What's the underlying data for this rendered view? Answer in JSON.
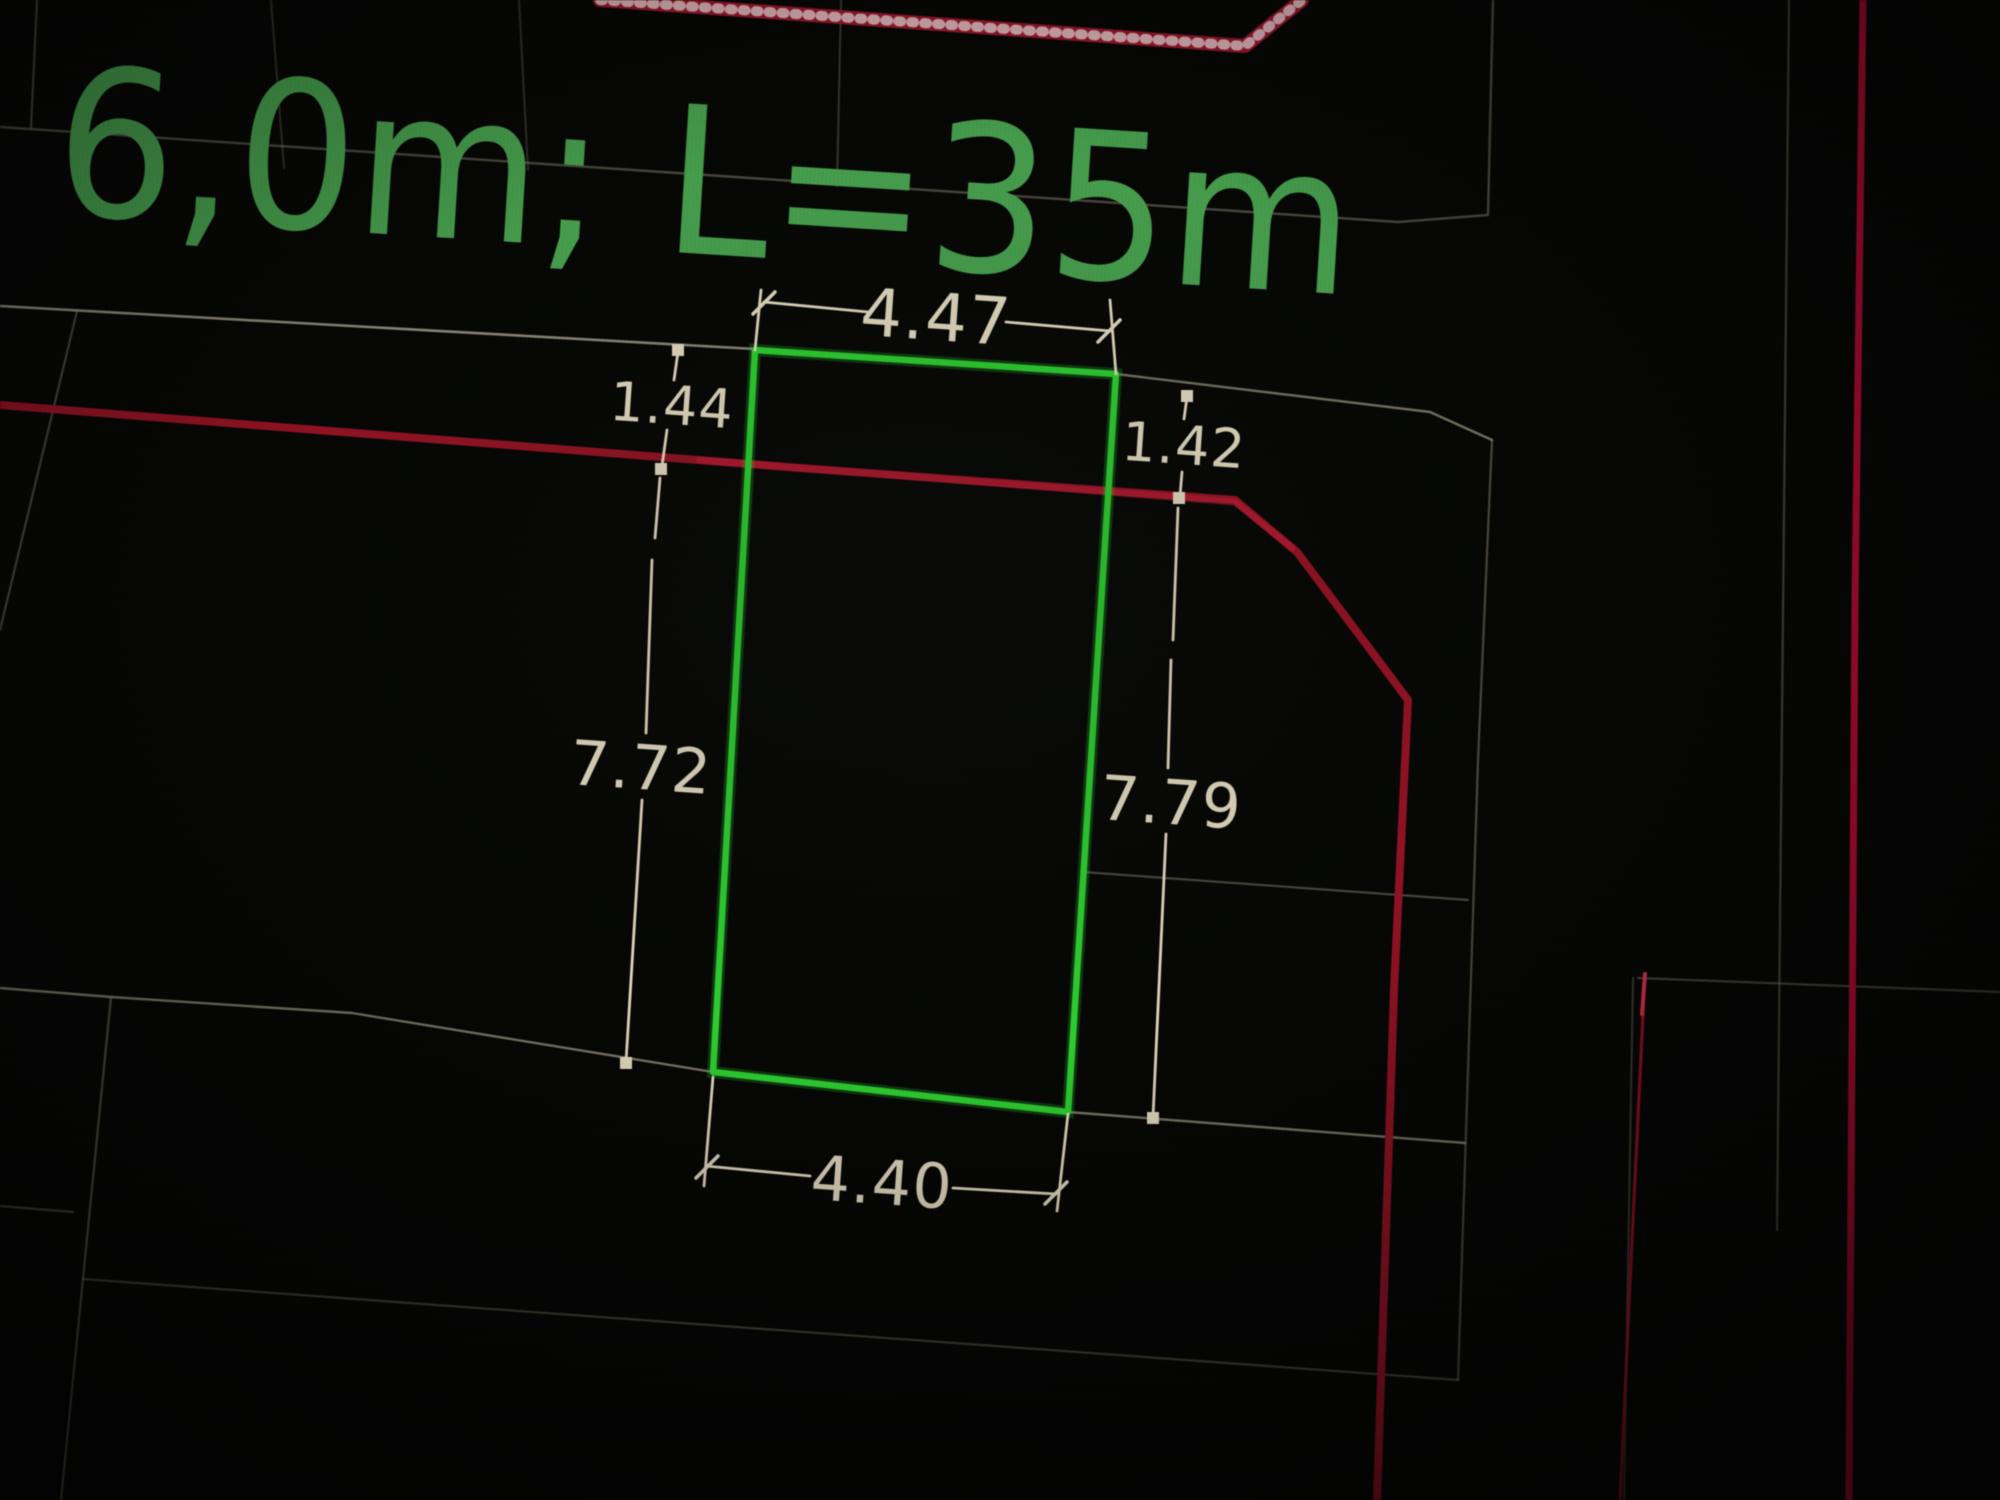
{
  "scene": {
    "description": "Photo of a CAD site plan on screen: highlighted parcel rectangle with measured dimensions",
    "annotation": {
      "label": "6,0m; L=35m"
    },
    "dimensions": {
      "top_width": "4.47",
      "front_offset_left": "1.44",
      "front_offset_right": "1.42",
      "depth_left": "7.72",
      "depth_right": "7.79",
      "bottom_width": "4.40"
    },
    "colors": {
      "background": "#060705",
      "annotation_green": "#479a4d",
      "parcel_green": "#2fc832",
      "dimension_cream": "#d9d1b8",
      "boundary_dark_red": "#8e1626",
      "boundary_bright_red": "#ad1034",
      "thin_red": "#a01530",
      "hatched_red": "#9c1b2e",
      "parcel_gray": "#7b7767"
    }
  }
}
